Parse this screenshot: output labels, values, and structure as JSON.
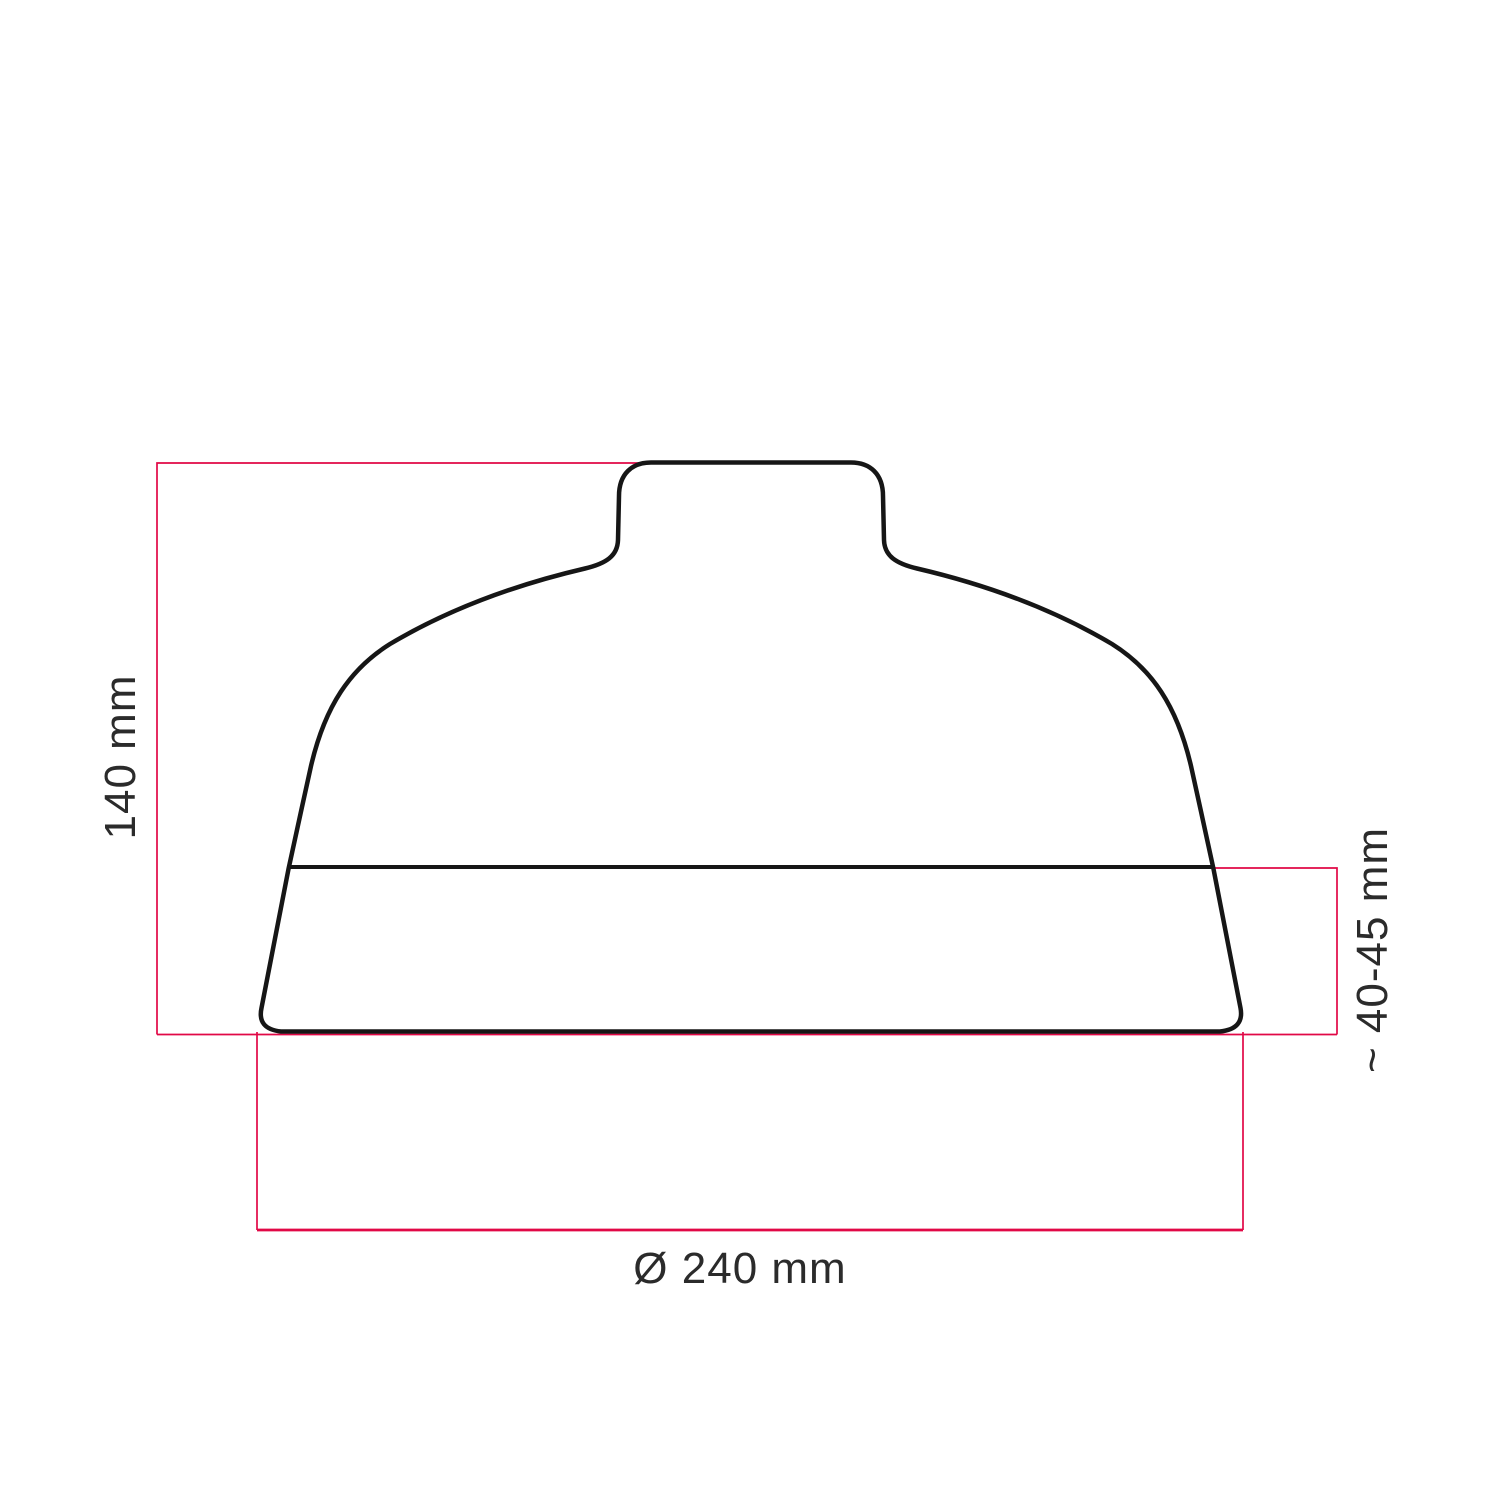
{
  "drawing": {
    "type": "technical-dimension-diagram",
    "subject": "ceramic lampshade profile, front elevation",
    "labels": {
      "height": "140 mm",
      "band_height": "~ 40-45 mm",
      "diameter": "Ø 240 mm"
    },
    "dimensions": {
      "height_mm": 140,
      "band_height_mm": "40-45",
      "diameter_mm": 240
    },
    "colors": {
      "dimension_lines": "#e10846",
      "outline": "#161616",
      "label_text": "#2b2b2b",
      "background": "#ffffff"
    }
  }
}
